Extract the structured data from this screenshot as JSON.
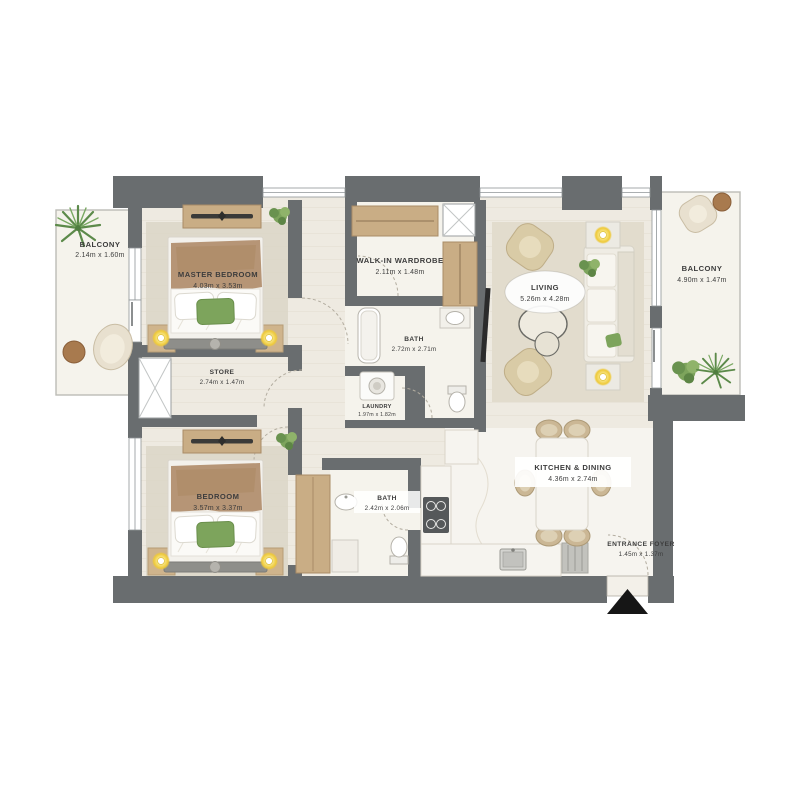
{
  "document": {
    "kind": "apartment floor plan",
    "background": "#ffffff"
  },
  "rooms": [
    {
      "name": "BALCONY",
      "dims": "2.14m x 1.60m"
    },
    {
      "name": "MASTER BEDROOM",
      "dims": "4.03m x 3.53m"
    },
    {
      "name": "WALK-IN WARDROBE",
      "dims": "2.11m x 1.48m"
    },
    {
      "name": "BATH",
      "dims": "2.72m x 2.71m"
    },
    {
      "name": "LAUNDRY",
      "dims": "1.97m x 1.82m"
    },
    {
      "name": "STORE",
      "dims": "2.74m x 1.47m"
    },
    {
      "name": "BEDROOM",
      "dims": "3.57m x 3.37m"
    },
    {
      "name": "BATH",
      "dims": "2.42m x 2.06m"
    },
    {
      "name": "LIVING",
      "dims": "5.26m x 4.28m"
    },
    {
      "name": "BALCONY",
      "dims": "4.90m x 1.47m"
    },
    {
      "name": "KITCHEN & DINING",
      "dims": "4.36m x 2.74m"
    },
    {
      "name": "ENTRANCE FOYER",
      "dims": "1.45m x 1.37m"
    }
  ],
  "colors": {
    "wall": "#696d6f",
    "floor": "#eeeae1",
    "balcony_floor": "#f5f3ec",
    "wood": "#c9ad85",
    "rug": "#e2dccd",
    "plant_green": "#7da45c",
    "lamp_yellow": "#eec93a",
    "marble": "#f6f4ef",
    "entrance_arrow": "#161616",
    "label_text": "#3c3c3c"
  },
  "icons": [
    "palm-plant-icon",
    "small-plant-icon",
    "bed-icon",
    "dresser-icon",
    "lamp-icon",
    "armchair-icon",
    "sofa-icon",
    "coffee-table-icon",
    "tv-icon",
    "dining-table-icon",
    "dining-chair-icon",
    "stove-icon",
    "kitchen-sink-icon",
    "bathtub-icon",
    "toilet-icon",
    "vanity-sink-icon",
    "washer-icon",
    "duct-shaft-icon",
    "door-swing-icon",
    "balcony-chair-icon",
    "balcony-table-icon",
    "door-mat-icon",
    "north-arrow-icon"
  ]
}
